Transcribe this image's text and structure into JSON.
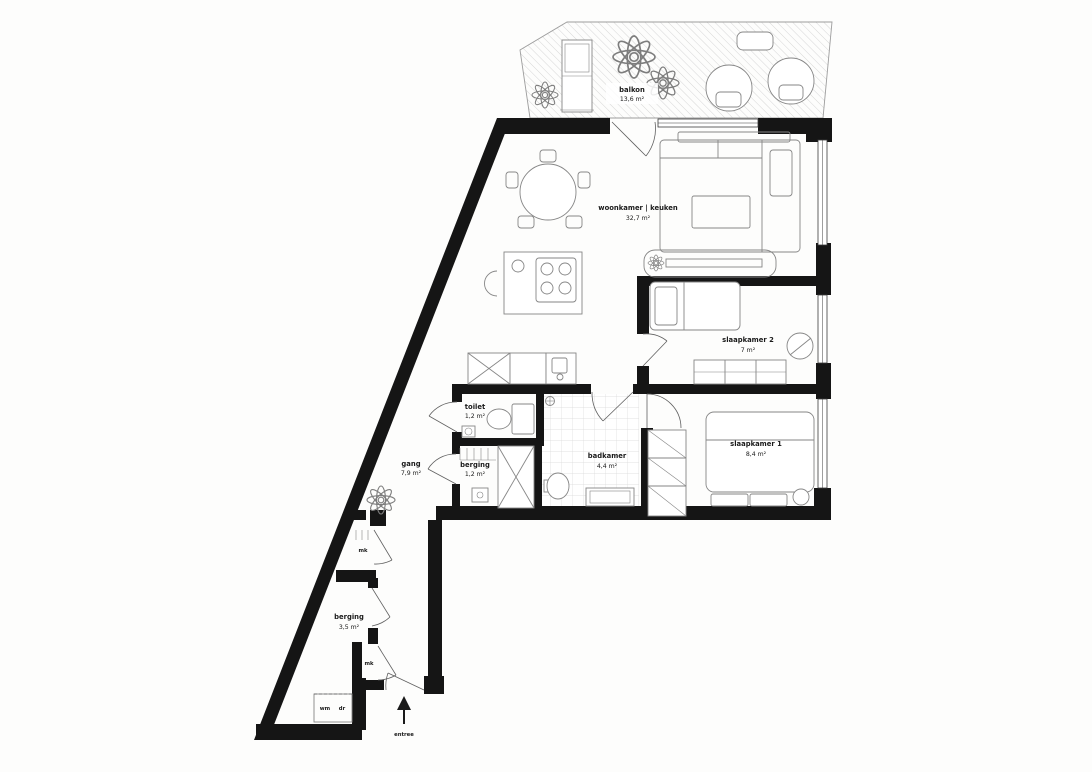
{
  "colors": {
    "wall": "#151515",
    "furniture": "#868686",
    "text": "#1a1a1a",
    "hatch": "#c6c6c6",
    "tile": "#d9d9d9"
  },
  "rooms": [
    {
      "name": "balkon",
      "area": "13,6 m²"
    },
    {
      "name": "woonkamer | keuken",
      "area": "32,7 m²"
    },
    {
      "name": "slaapkamer 2",
      "area": "7 m²"
    },
    {
      "name": "slaapkamer 1",
      "area": "8,4 m²"
    },
    {
      "name": "badkamer",
      "area": "4,4 m²"
    },
    {
      "name": "toilet",
      "area": "1,2 m²"
    },
    {
      "name": "berging",
      "area": "1,2 m²"
    },
    {
      "name": "gang",
      "area": "7,9 m²"
    },
    {
      "name": "berging",
      "area": "3,5 m²"
    }
  ],
  "small_labels": {
    "meter_cupboard_top": "mk",
    "meter_cupboard_bottom": "mk",
    "washer": "wm",
    "dryer": "dr",
    "entrance": "entree"
  }
}
